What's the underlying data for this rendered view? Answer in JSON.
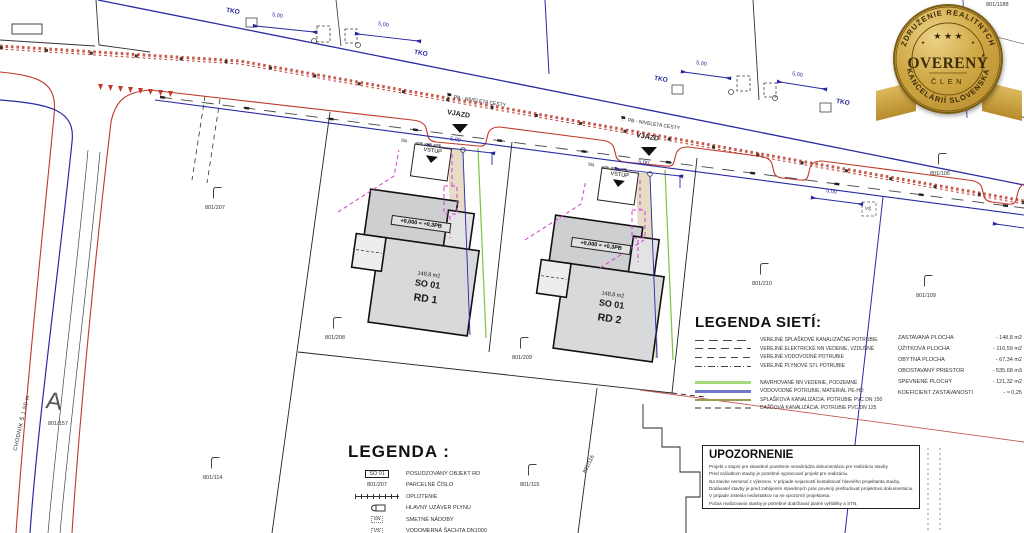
{
  "drawing": {
    "houses": {
      "rd1": {
        "level_label": "+0,000 = +0,3PB",
        "area": "148,8 m2",
        "object_id": "SO 01",
        "name": "RD 1"
      },
      "rd2": {
        "level_label": "+0,000 = +0,3PB",
        "area": "148,8 m2",
        "object_id": "SO 01",
        "name": "RD 2"
      }
    },
    "road_labels": {
      "tko": "TKO",
      "dim_5m": "5,00",
      "pb_niveleta": "PB - NIVELETA CESTY",
      "vjazd": "VJAZD",
      "vstup": "VSTUP",
      "sn": "SN",
      "vs": "VŠ"
    },
    "parcel_numbers": {
      "p1188": "801/1188",
      "p106": "801/106",
      "p109": "801/109",
      "p210": "801/210",
      "p207": "801/207",
      "p208": "801/208",
      "p209": "801/209",
      "p157": "801/157",
      "p114": "801/114",
      "p115": "801/115",
      "p116": "801/116"
    },
    "sidewalk_label": "CHODNÍK Š 1,50 m",
    "a_mark": "A"
  },
  "legend_networks": {
    "title": "LEGENDA SIETÍ:",
    "items": [
      {
        "label": "VEREJNÉ SPLAŠKOVÉ KANALIZAČNÉ POTRUBIE"
      },
      {
        "label": "VEREJNÉ ELEKTRICKÉ NN VEDENIE, VZDUŠNÉ"
      },
      {
        "label": "VEREJNÉ VODOVODNÉ POTRUBIE"
      },
      {
        "label": "VEREJNÉ PLYNOVÉ STL POTRUBIE"
      },
      {
        "label": "NAVRHOVANÉ NN VEDENIE, PODZEMNÉ"
      },
      {
        "label": "VODOVODNÉ POTRUBIE, MATERIÁL PE-HD"
      },
      {
        "label": "SPLAŠKOVÁ KANALIZÁCIA, POTRUBIE PVC DN 150"
      },
      {
        "label": "DAŽĎOVÁ KANALIZÁCIA, POTRUBIE PVC DN 125"
      }
    ]
  },
  "area_stats": {
    "rows": [
      {
        "label": "ZASTAVANÁ PLOCHA",
        "value": "- 148,8 m2"
      },
      {
        "label": "ÚŽITKOVÁ PLOCHA",
        "value": "- 116,59 m2"
      },
      {
        "label": "OBYTNÁ PLOCHA",
        "value": "- 67,34 m2"
      },
      {
        "label": "OBOSTAVANÝ PRIESTOR",
        "value": "- 535,68 m3"
      },
      {
        "label": "SPEVNENÉ PLOCHY",
        "value": "- 121,32 m2"
      },
      {
        "label": "KOEFICIENT ZASTAVANOSTI",
        "value": "- ≈ 0,25"
      }
    ]
  },
  "legend_main": {
    "title": "LEGENDA :",
    "items": [
      {
        "symbol": "SO 01",
        "label": "POSUDZOVANÝ OBJEKT RD"
      },
      {
        "symbol": "801/207",
        "label": "PARCELNÉ ČÍSLO"
      },
      {
        "symbol": "",
        "label": "OPLOTENIE"
      },
      {
        "symbol": "",
        "label": "HLAVNÝ UZÁVER PLYNU"
      },
      {
        "symbol": "SN",
        "label": "SMETNÉ NÁDOBY"
      },
      {
        "symbol": "VŠ",
        "label": "VODOMERNÁ ŠACHTA DN1000"
      },
      {
        "symbol": "E",
        "label": "ELEKTROMER"
      }
    ]
  },
  "notice": {
    "title": "UPOZORNENIE",
    "lines": [
      "Projekt v stupni pre stavebné povolenie nenahrádza dokumentáciu pre realizáciu stavby.",
      "Pred začiatkom stavby je potrebné vypracovať projekt pre realizáciu.",
      "Na stavbe nemerať z výkresov. V prípade nejasností kontaktovať hlavného projektanta stavby.",
      "Dodávateľ stavby je pred zahájením stavebných prác povinný preštudovať projektovú dokumentáciu.",
      "V prípade zistenia nedostatkov na ne upozorniť projektanta.",
      "Počas realizovania stavby je potrebné dodržiavať platné vyhlášky a STN."
    ]
  },
  "badge": {
    "arc_top": "ZDRUŽENIE REALITNÝCH",
    "title": "OVERENÝ",
    "subtitle": "ČLEN",
    "arc_bottom": "KANCELÁRIÍ SLOVENSKA",
    "stars": "★ ★ ★",
    "star_small": "★"
  },
  "colors": {
    "road_red": "#c0392b",
    "utility_blue": "#2929a3",
    "proposed_green": "#7dc242",
    "gas_magenta": "#cf3fcf",
    "sewer_olive": "#9b9b58",
    "badge_gold": "#c9a23d",
    "house_fill": "#d9d9d9"
  }
}
